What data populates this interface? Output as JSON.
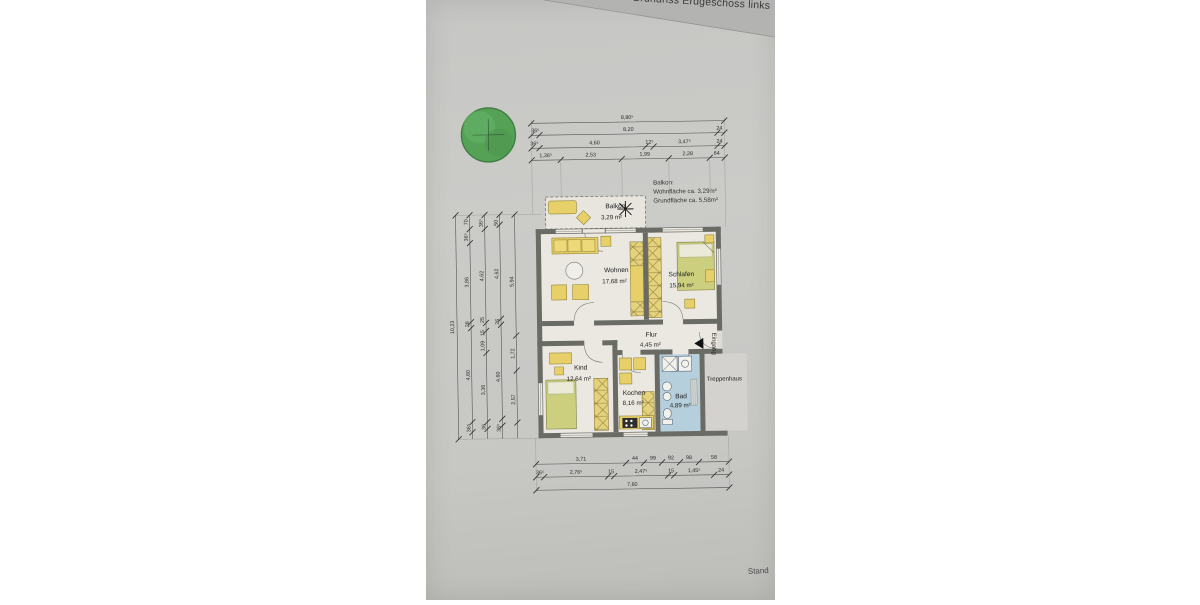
{
  "photo": {
    "title": "Grundriss Erdgeschoss links",
    "stand_label": "Stand"
  },
  "balkon_note": {
    "line1": "Balkon:",
    "line2": "Wohnfläche ca. 3,29m²",
    "line3": "Grundfläche ca. 5,58m²"
  },
  "rooms": {
    "balkon": {
      "name": "Balkon",
      "area": "3,29 m²"
    },
    "wohnen": {
      "name": "Wohnen",
      "area": "17,68 m²"
    },
    "schlafen": {
      "name": "Schlafen",
      "area": "15,94 m²"
    },
    "flur": {
      "name": "Flur",
      "area": "4,45 m²"
    },
    "kind": {
      "name": "Kind",
      "area": "12,64 m²"
    },
    "kochen": {
      "name": "Kochen",
      "area": "8,16 m²"
    },
    "bad": {
      "name": "Bad",
      "area": "4,89 m²"
    }
  },
  "labels": {
    "eingang": "Eingang",
    "treppenhaus": "Treppenhaus"
  },
  "dimensions": {
    "top": {
      "row1": [
        "8,80⁵"
      ],
      "row2": [
        "36⁵",
        "8,20",
        "24"
      ],
      "row3": [
        "36⁵",
        "4,60",
        "12⁵",
        "3,47⁵",
        "24"
      ],
      "row4": [
        "1,36⁵",
        "2,53",
        "1,99",
        "2,28",
        "64"
      ]
    },
    "bottom": {
      "row1": [
        "3,71",
        "44",
        "99",
        "92",
        "98",
        "58"
      ],
      "row2": [
        "36⁵",
        "2,76⁵",
        "15",
        "2,47⁵",
        "15",
        "1,45⁵",
        "24"
      ],
      "row3": [
        "7,60"
      ]
    },
    "left": {
      "total": "10,23",
      "col1": [
        "70",
        "36⁵",
        "3,86",
        "28",
        "4,60",
        "36⁵"
      ],
      "col2": [
        "36⁵",
        "4,62",
        "25",
        "15",
        "1,09",
        "3,36",
        "36"
      ],
      "col3": [
        "50",
        "4,62",
        "26",
        "4,60",
        "36⁵"
      ],
      "col4": [
        "5,94",
        "1,72",
        "2,57"
      ]
    }
  },
  "colors": {
    "paper": "#c8c8c5",
    "fold_strip": "#b3b3b1",
    "wall": "#6b6b66",
    "floor": "#eae8e1",
    "furniture_yellow": "#e7d069",
    "bed_green": "#ccd07e",
    "bath_blue": "#b6cfdc",
    "tree_green": "#55a257",
    "dimension_line": "#4a4a4a"
  }
}
